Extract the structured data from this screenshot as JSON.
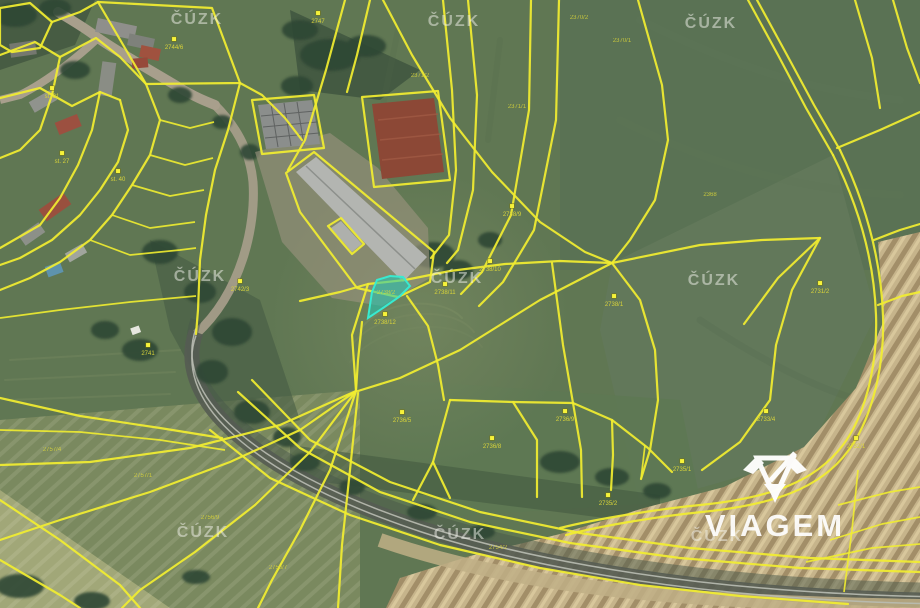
{
  "map": {
    "type": "cadastral-satellite-view",
    "highlight_parcel": {
      "fill": "#1fc9b7",
      "stroke": "#38ead0",
      "fill_opacity": 0.55,
      "label": "2738/2"
    },
    "boundary_color": "#f1ed30",
    "marker_color": "#f6f23a",
    "label_color": "#d9d43a"
  },
  "watermark": {
    "text": "ČÚZK",
    "color": "rgba(244,244,238,0.5)",
    "positions": [
      {
        "x": 197,
        "y": 24
      },
      {
        "x": 454,
        "y": 26
      },
      {
        "x": 711,
        "y": 28
      },
      {
        "x": 200,
        "y": 281
      },
      {
        "x": 457,
        "y": 283
      },
      {
        "x": 714,
        "y": 285
      },
      {
        "x": 203,
        "y": 537
      },
      {
        "x": 460,
        "y": 539
      },
      {
        "x": 717,
        "y": 541
      }
    ]
  },
  "branding": {
    "logo_text": "VIAGEM",
    "logo_mark": "gem-v-icon",
    "color": "#ffffff"
  },
  "parcel_markers": [
    {
      "x": 318,
      "y": 13,
      "label": "2747"
    },
    {
      "x": 174,
      "y": 39,
      "label": "2744/6"
    },
    {
      "x": 52,
      "y": 88,
      "label": "st. 31"
    },
    {
      "x": 62,
      "y": 153,
      "label": "st. 27"
    },
    {
      "x": 118,
      "y": 171,
      "label": "st. 40"
    },
    {
      "x": 240,
      "y": 281,
      "label": "2742/3"
    },
    {
      "x": 148,
      "y": 345,
      "label": "2741"
    },
    {
      "x": 385,
      "y": 314,
      "label": "2738/12"
    },
    {
      "x": 445,
      "y": 284,
      "label": "2738/11"
    },
    {
      "x": 490,
      "y": 261,
      "label": "2738/10"
    },
    {
      "x": 512,
      "y": 206,
      "label": "2738/9"
    },
    {
      "x": 614,
      "y": 296,
      "label": "2738/1"
    },
    {
      "x": 402,
      "y": 412,
      "label": "2736/5"
    },
    {
      "x": 492,
      "y": 438,
      "label": "2736/8"
    },
    {
      "x": 565,
      "y": 411,
      "label": "2736/9"
    },
    {
      "x": 608,
      "y": 495,
      "label": "2735/2"
    },
    {
      "x": 682,
      "y": 461,
      "label": "2735/1"
    },
    {
      "x": 766,
      "y": 411,
      "label": "2733/4"
    },
    {
      "x": 856,
      "y": 438,
      "label": "2732/1"
    },
    {
      "x": 820,
      "y": 283,
      "label": "2731/2"
    }
  ],
  "parcel_labels": [
    {
      "x": 579,
      "y": 19,
      "label": "2370/2"
    },
    {
      "x": 622,
      "y": 42,
      "label": "2370/1"
    },
    {
      "x": 420,
      "y": 77,
      "label": "2371/2"
    },
    {
      "x": 517,
      "y": 108,
      "label": "2371/1"
    },
    {
      "x": 710,
      "y": 196,
      "label": "2368"
    },
    {
      "x": 386,
      "y": 294,
      "label": "2738/2"
    },
    {
      "x": 52,
      "y": 451,
      "label": "2757/4"
    },
    {
      "x": 143,
      "y": 477,
      "label": "2757/1"
    },
    {
      "x": 210,
      "y": 519,
      "label": "2756/9"
    },
    {
      "x": 278,
      "y": 569,
      "label": "2756/7"
    },
    {
      "x": 498,
      "y": 549,
      "label": "2754/2"
    }
  ]
}
